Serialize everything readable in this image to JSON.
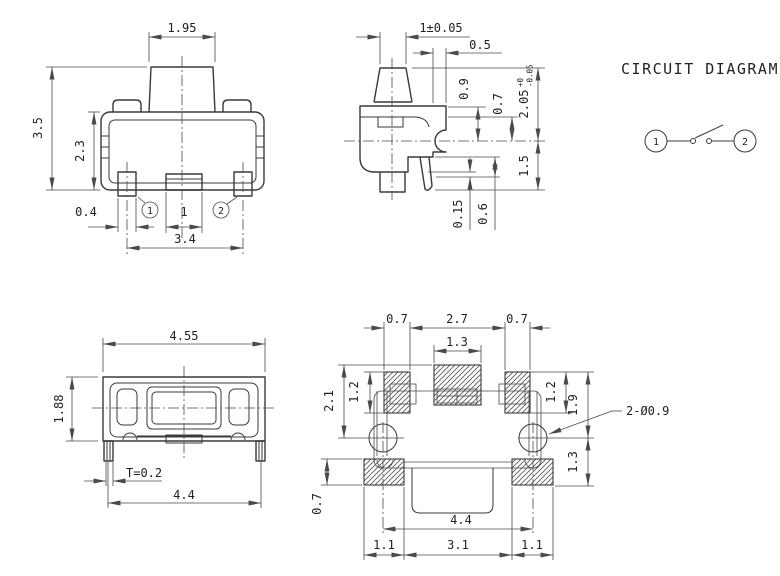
{
  "front_view": {
    "dims": {
      "knob_width": "1.95",
      "total_height": "3.5",
      "body_height": "2.3",
      "lead_width": "0.4",
      "center_tab_width": "1",
      "lead_pitch": "3.4"
    },
    "pins": {
      "pin1": "1",
      "pin2": "2"
    }
  },
  "side_view": {
    "dims": {
      "knob_width_tol": "1±0.05",
      "top_offset": "0.5",
      "upper_body": "0.9",
      "contact_height": "0.7",
      "height_above_board": "2.05",
      "height_tol_plus": "+0",
      "height_tol_minus": "-0.05",
      "below_board": "1.5",
      "lead_thickness": "0.15",
      "lead_tip": "0.6"
    }
  },
  "top_view": {
    "dims": {
      "overall_width": "4.55",
      "overall_depth": "1.88",
      "terminal_thickness": "T=0.2",
      "terminal_span": "4.4"
    }
  },
  "land_pattern": {
    "dims": {
      "side_pad_w_left": "0.7",
      "pad_inner_span": "2.7",
      "side_pad_w_right": "0.7",
      "center_pad_w": "1.3",
      "side_pad_h_left": "1.2",
      "pad_top_to_hole": "2.1",
      "side_pad_h_right": "1.2",
      "hole_to_pad_top_right": "1.9",
      "hole_to_pad_bottom": "1.3",
      "holes_note": "2-Ø0.9",
      "bottom_pad_h": "0.7",
      "hole_span": "4.4",
      "bottom_left_w": "1.1",
      "bottom_center_w": "3.1",
      "bottom_right_w": "1.1"
    }
  },
  "circuit": {
    "title": "CIRCUIT DIAGRAM",
    "pin1": "1",
    "pin2": "2"
  }
}
